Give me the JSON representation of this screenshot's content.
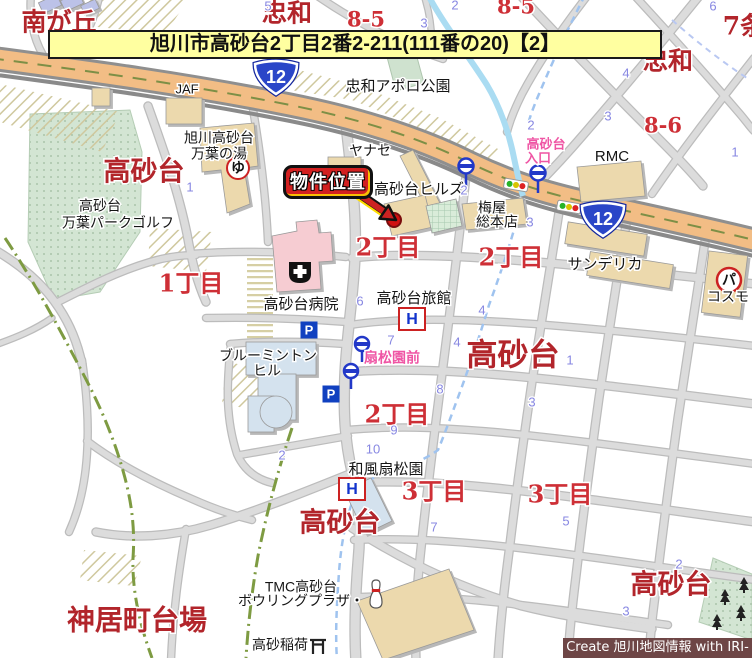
{
  "banner": {
    "title": "旭川市高砂台2丁目2番2-211(111番の20)【2】"
  },
  "credit": {
    "text": "Create 旭川地図情報 with IRI-GO"
  },
  "callout": {
    "label": "物件位置"
  },
  "route_number": "12",
  "icon_letters": {
    "onsen": "ゆ",
    "parking_lot": "パ",
    "hotel": "H",
    "parking": "P"
  },
  "colors": {
    "highway": "#f2bd85",
    "park": "#d3e5d3",
    "building": "#ecd9ad",
    "hospital": "#f6ccd2",
    "accent_red": "#d22020",
    "banner_bg": "#ffffa0",
    "credit_bg": "#6e4646",
    "pink_label": "#ef55a4",
    "blue_number": "#8787e2"
  },
  "map_labels": [
    {
      "t": "南が丘",
      "x": 59,
      "y": 24,
      "cls": "area",
      "s": 25
    },
    {
      "t": "忠和",
      "x": 287,
      "y": 15,
      "cls": "area",
      "s": 25
    },
    {
      "t": "忠和",
      "x": 668,
      "y": 63,
      "cls": "area",
      "s": 25
    },
    {
      "t": "7条",
      "x": 744,
      "y": 28,
      "cls": "area",
      "s": 25
    },
    {
      "t": "高砂台",
      "x": 144,
      "y": 173,
      "cls": "area",
      "s": 27
    },
    {
      "t": "高砂台",
      "x": 513,
      "y": 357,
      "cls": "area",
      "s": 31
    },
    {
      "t": "高砂台",
      "x": 340,
      "y": 524,
      "cls": "area",
      "s": 27
    },
    {
      "t": "高砂台",
      "x": 671,
      "y": 586,
      "cls": "area",
      "s": 27
    },
    {
      "t": "神居町台場",
      "x": 137,
      "y": 622,
      "cls": "area",
      "s": 28
    },
    {
      "t": "8-5",
      "x": 366,
      "y": 21,
      "cls": "block",
      "s": 21
    },
    {
      "t": "8-5",
      "x": 516,
      "y": 8,
      "cls": "block",
      "s": 21
    },
    {
      "t": "8-6",
      "x": 663,
      "y": 127,
      "cls": "block",
      "s": 21
    },
    {
      "t": "1丁目",
      "x": 191,
      "y": 285,
      "cls": "block",
      "s": 24
    },
    {
      "t": "2丁目",
      "x": 388,
      "y": 249,
      "cls": "block",
      "s": 24
    },
    {
      "t": "2丁目",
      "x": 511,
      "y": 259,
      "cls": "block",
      "s": 24
    },
    {
      "t": "2丁目",
      "x": 397,
      "y": 416,
      "cls": "block",
      "s": 24
    },
    {
      "t": "3丁目",
      "x": 434,
      "y": 493,
      "cls": "block",
      "s": 24
    },
    {
      "t": "3丁目",
      "x": 560,
      "y": 496,
      "cls": "block",
      "s": 24
    },
    {
      "t": "JAF",
      "x": 187,
      "y": 90,
      "cls": "poi",
      "s": 13
    },
    {
      "t": "旭川高砂台",
      "x": 219,
      "y": 139,
      "cls": "poi",
      "s": 14
    },
    {
      "t": "万葉の湯",
      "x": 219,
      "y": 155,
      "cls": "poi",
      "s": 14
    },
    {
      "t": "高砂台",
      "x": 100,
      "y": 207,
      "cls": "poi",
      "s": 14
    },
    {
      "t": "万葉パークゴルフ",
      "x": 118,
      "y": 224,
      "cls": "poi",
      "s": 14
    },
    {
      "t": "忠和アポロ公園",
      "x": 398,
      "y": 87,
      "cls": "poi",
      "s": 15
    },
    {
      "t": "ヤナセ",
      "x": 370,
      "y": 152,
      "cls": "poi",
      "s": 14
    },
    {
      "t": "高砂台ヒルズ",
      "x": 419,
      "y": 190,
      "cls": "poi",
      "s": 15
    },
    {
      "t": "梅屋",
      "x": 492,
      "y": 209,
      "cls": "poi",
      "s": 14
    },
    {
      "t": "総本店",
      "x": 497,
      "y": 223,
      "cls": "poi",
      "s": 14
    },
    {
      "t": "RMC",
      "x": 612,
      "y": 157,
      "cls": "poi",
      "s": 15
    },
    {
      "t": "サンデリカ",
      "x": 605,
      "y": 265,
      "cls": "poi",
      "s": 15
    },
    {
      "t": "コスモ",
      "x": 728,
      "y": 298,
      "cls": "poi",
      "s": 14
    },
    {
      "t": "高砂台病院",
      "x": 301,
      "y": 305,
      "cls": "poi",
      "s": 15
    },
    {
      "t": "高砂台旅館",
      "x": 414,
      "y": 299,
      "cls": "poi",
      "s": 15
    },
    {
      "t": "ブルーミントン",
      "x": 268,
      "y": 357,
      "cls": "poi",
      "s": 14
    },
    {
      "t": "ヒル",
      "x": 267,
      "y": 372,
      "cls": "poi",
      "s": 14
    },
    {
      "t": "和風扇松園",
      "x": 386,
      "y": 470,
      "cls": "poi",
      "s": 15
    },
    {
      "t": "TMC高砂台",
      "x": 301,
      "y": 588,
      "cls": "poi",
      "s": 14
    },
    {
      "t": "ボウリングプラザ・",
      "x": 301,
      "y": 602,
      "cls": "poi",
      "s": 14
    },
    {
      "t": "高砂稲荷",
      "x": 280,
      "y": 646,
      "cls": "poi",
      "s": 14
    },
    {
      "t": "高砂台",
      "x": 546,
      "y": 145,
      "cls": "pink",
      "s": 13
    },
    {
      "t": "入口",
      "x": 538,
      "y": 159,
      "cls": "pink",
      "s": 13
    },
    {
      "t": "扇松園前",
      "x": 392,
      "y": 359,
      "cls": "pink",
      "s": 14
    },
    {
      "t": "5",
      "x": 268,
      "y": 7,
      "cls": "num",
      "s": 13
    },
    {
      "t": "2",
      "x": 455,
      "y": 6,
      "cls": "num",
      "s": 13
    },
    {
      "t": "3",
      "x": 424,
      "y": 24,
      "cls": "num",
      "s": 13
    },
    {
      "t": "6",
      "x": 713,
      "y": 7,
      "cls": "num",
      "s": 13
    },
    {
      "t": "4",
      "x": 626,
      "y": 74,
      "cls": "num",
      "s": 13
    },
    {
      "t": "3",
      "x": 608,
      "y": 117,
      "cls": "num",
      "s": 13
    },
    {
      "t": "2",
      "x": 531,
      "y": 126,
      "cls": "num",
      "s": 13
    },
    {
      "t": "1",
      "x": 735,
      "y": 153,
      "cls": "num",
      "s": 13
    },
    {
      "t": "1",
      "x": 190,
      "y": 188,
      "cls": "num",
      "s": 13
    },
    {
      "t": "2",
      "x": 464,
      "y": 191,
      "cls": "num",
      "s": 13
    },
    {
      "t": "3",
      "x": 530,
      "y": 223,
      "cls": "num",
      "s": 13
    },
    {
      "t": "6",
      "x": 360,
      "y": 302,
      "cls": "num",
      "s": 13
    },
    {
      "t": "4",
      "x": 482,
      "y": 311,
      "cls": "num",
      "s": 13
    },
    {
      "t": "7",
      "x": 391,
      "y": 341,
      "cls": "num",
      "s": 13
    },
    {
      "t": "4",
      "x": 457,
      "y": 343,
      "cls": "num",
      "s": 13
    },
    {
      "t": "1",
      "x": 570,
      "y": 361,
      "cls": "num",
      "s": 13
    },
    {
      "t": "8",
      "x": 440,
      "y": 390,
      "cls": "num",
      "s": 13
    },
    {
      "t": "3",
      "x": 532,
      "y": 403,
      "cls": "num",
      "s": 13
    },
    {
      "t": "9",
      "x": 394,
      "y": 431,
      "cls": "num",
      "s": 13
    },
    {
      "t": "10",
      "x": 373,
      "y": 450,
      "cls": "num",
      "s": 13
    },
    {
      "t": "2",
      "x": 282,
      "y": 456,
      "cls": "num",
      "s": 13
    },
    {
      "t": "7",
      "x": 434,
      "y": 528,
      "cls": "num",
      "s": 13
    },
    {
      "t": "5",
      "x": 566,
      "y": 522,
      "cls": "num",
      "s": 13
    },
    {
      "t": "2",
      "x": 679,
      "y": 565,
      "cls": "num",
      "s": 13
    },
    {
      "t": "3",
      "x": 626,
      "y": 612,
      "cls": "num",
      "s": 13
    }
  ]
}
